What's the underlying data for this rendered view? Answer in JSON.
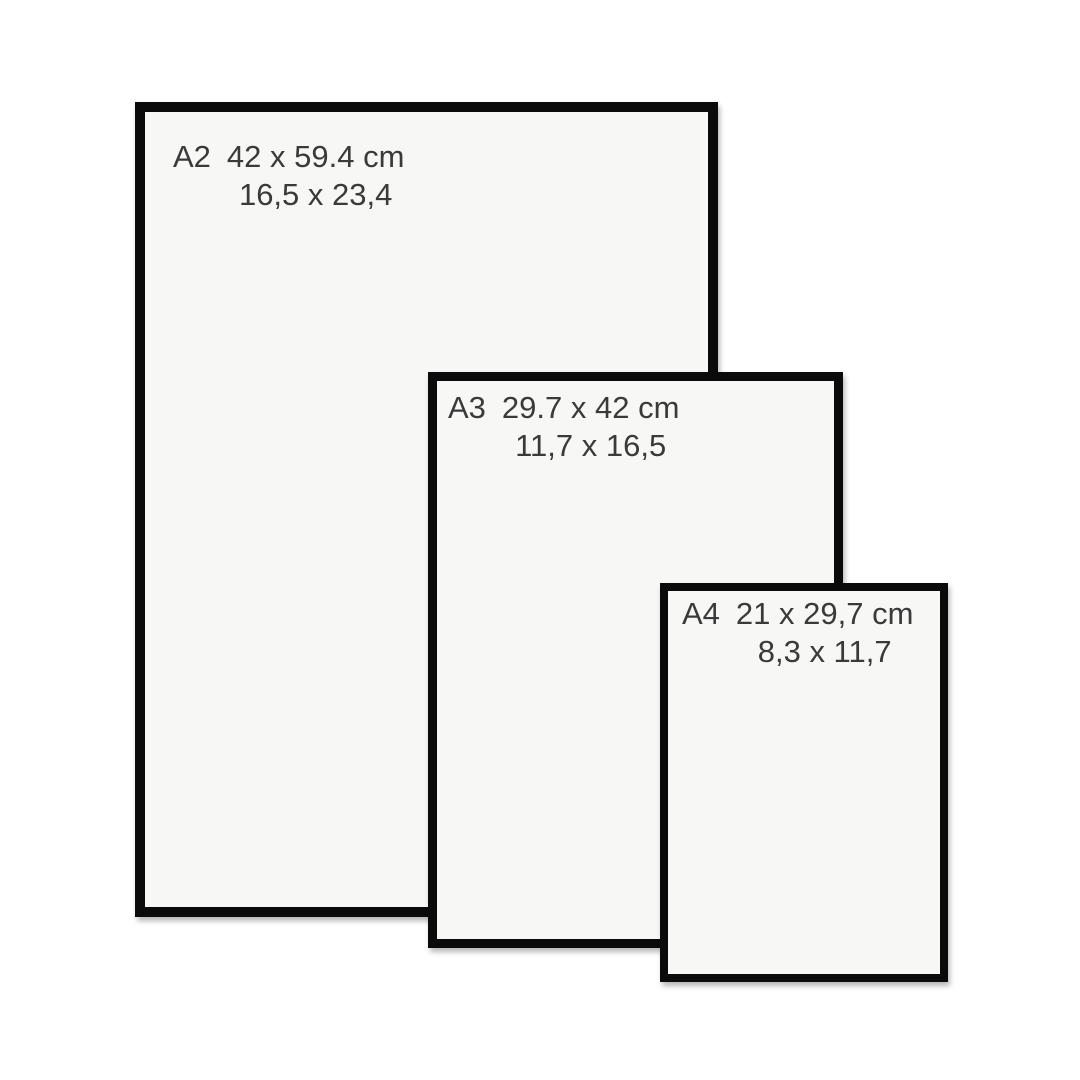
{
  "frames": [
    {
      "id": "a2",
      "label": "A2",
      "dimensions_cm": "42 x 59.4 cm",
      "dimensions_in": "16,5 x 23,4"
    },
    {
      "id": "a3",
      "label": "A3",
      "dimensions_cm": "29.7 x 42 cm",
      "dimensions_in": "11,7 x 16,5"
    },
    {
      "id": "a4",
      "label": "A4",
      "dimensions_cm": "21 x 29,7 cm",
      "dimensions_in": "8,3 x 11,7"
    }
  ],
  "colors": {
    "background": "#ffffff",
    "frame_border": "#0b0b0b",
    "paper": "#f7f7f6",
    "text": "#3a3a3a"
  }
}
